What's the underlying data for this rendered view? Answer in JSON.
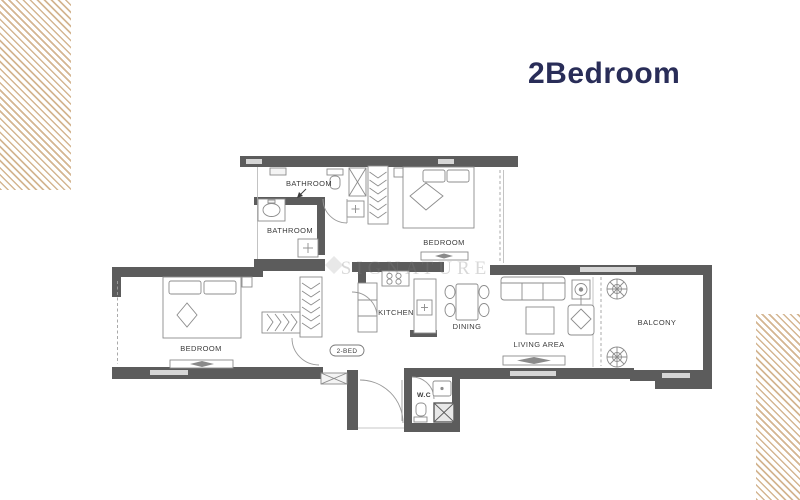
{
  "title": "2Bedroom",
  "watermark": "SIGNATURE",
  "unit_badge": "2-BED",
  "rooms": {
    "bathroom_top": "BATHROOM",
    "bathroom_main": "BATHROOM",
    "bedroom_top": "BEDROOM",
    "bedroom_left": "BEDROOM",
    "kitchen": "KITCHEN",
    "dining": "DINING",
    "living": "LIVING AREA",
    "balcony": "BALCONY",
    "wc": "W.C"
  },
  "icons": {
    "plants": "plant-icon",
    "beds": "bed-icon",
    "tv": "tv-icon",
    "sofa": "sofa-icon",
    "dining_table": "dining-table-icon",
    "stove": "stove-icon",
    "toilet": "toilet-icon",
    "sink": "sink-icon",
    "wardrobe": "wardrobe-icon"
  },
  "colors": {
    "title": "#292d58",
    "wall": "#5c5c5c",
    "accent_stripe": "#c69e6d",
    "label": "#3c3c3c"
  }
}
